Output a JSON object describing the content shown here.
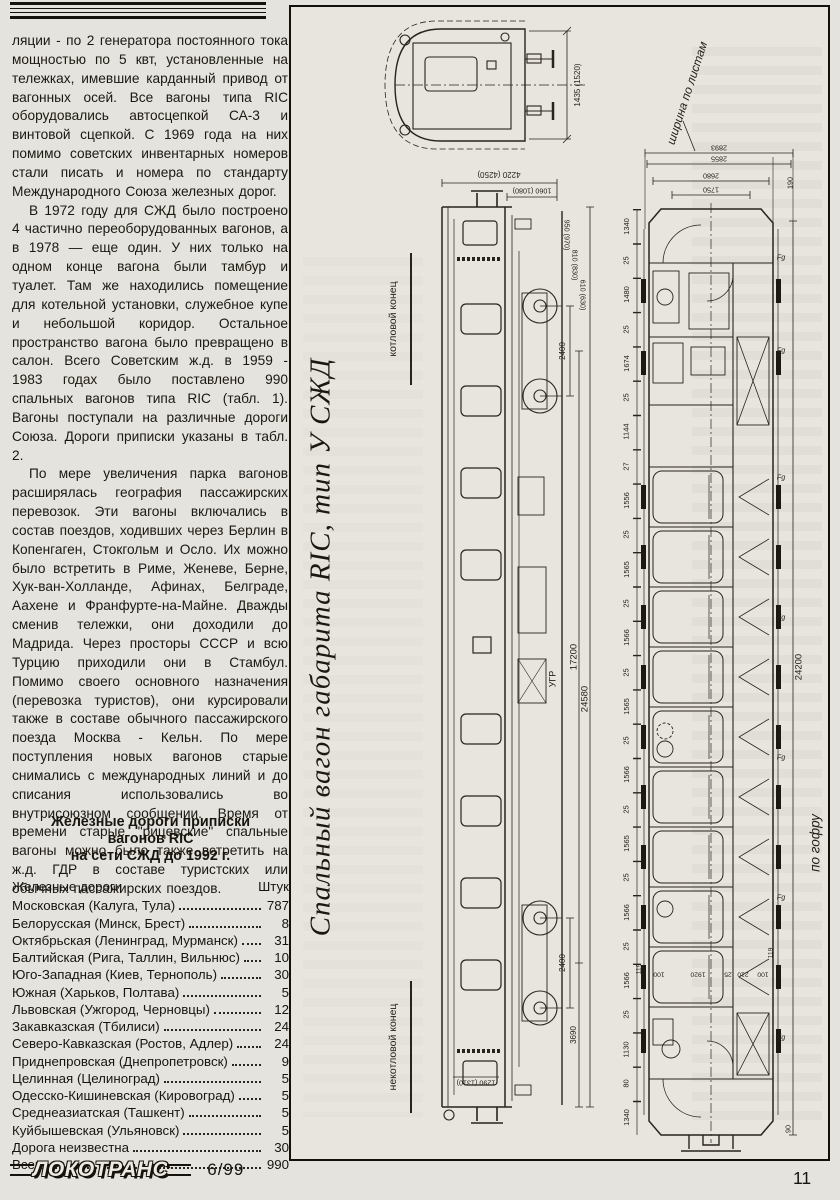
{
  "page": {
    "number": "11",
    "issue": "6/99",
    "logo": "ЛОКОТРАНС"
  },
  "article": {
    "paragraphs": [
      "ляции - по 2 генератора постоянного тока мощностью по 5 квт, установленные на тележках, имевшие карданный привод от вагонных осей. Все вагоны типа RIC оборудовались автосцепкой СА-3 и винтовой сцепкой. С 1969 года на них помимо советских инвентарных номеров стали писать и номера по стандарту Международного Союза железных дорог.",
      "В 1972 году для СЖД было построено 4 частично переоборудованных вагонов, а в 1978 — еще один. У них только на одном конце вагона были тамбур и туалет. Там же находились помещение для котельной установки, служебное купе и небольшой коридор. Остальное пространство вагона было превращено в салон. Всего Советским ж.д. в 1959 - 1983 годах было поставлено 990 спальных вагонов типа RIC (табл. 1). Вагоны поступали на различные дороги Союза. Дороги приписки указаны в табл. 2.",
      "По мере увеличения парка вагонов расширялась география пассажирских перевозок. Эти вагоны включались в состав поездов, ходивших через Берлин в Копенгаген, Стокгольм и Осло. Их можно было встретить в Риме, Женеве, Берне, Хук-ван-Холланде, Афинах, Белграде, Аахене и Франфурте-на-Майне. Дважды сменив тележки, они доходили до Мадрида. Через просторы СССР и всю Турцию приходили они в Стамбул. Помимо своего основного назначения (перевозка туристов), они курсировали также в составе обычного пассажирского поезда Москва - Кельн. По мере поступления новых вагонов старые снимались с международных линий и до списания использовались во внутрисоюзном сообщении. Время от времени старые \"рицевские\" спальные вагоны можно было также встретить на ж.д. ГДР в составе туристских или обычных пассажирских поездов."
    ]
  },
  "table": {
    "title_lines": [
      "Железные дороги приписки",
      "вагонов RIC",
      "на сети СЖД до 1992 г."
    ],
    "header": {
      "name": "Железные дороги",
      "count": "Штук"
    },
    "rows": [
      {
        "name": "Московская (Калуга, Тула)",
        "count": "787"
      },
      {
        "name": "Белорусская (Минск, Брест)",
        "count": "8"
      },
      {
        "name": "Октябрьская (Ленинград, Мурманск)",
        "count": "31"
      },
      {
        "name": "Балтийская (Рига, Таллин, Вильнюс)",
        "count": "10"
      },
      {
        "name": "Юго-Западная (Киев, Тернополь)",
        "count": "30"
      },
      {
        "name": "Южная (Харьков, Полтава)",
        "count": "5"
      },
      {
        "name": "Львовская (Ужгород, Черновцы)",
        "count": "12"
      },
      {
        "name": "Закавказская (Тбилиси)",
        "count": "24"
      },
      {
        "name": "Северо-Кавказская (Ростов, Адлер)",
        "count": "24"
      },
      {
        "name": "Приднепровская (Днепропетровск)",
        "count": "9"
      },
      {
        "name": "Целинная (Целиноград)",
        "count": "5"
      },
      {
        "name": "Одесско-Кишиневская (Кировоград)",
        "count": "5"
      },
      {
        "name": "Среднеазиатская (Ташкент)",
        "count": "5"
      },
      {
        "name": "Куйбышевская (Ульяновск)",
        "count": "5"
      },
      {
        "name": "Дорога неизвестна",
        "count": "30"
      },
      {
        "name": "Всего",
        "count": "990"
      }
    ]
  },
  "drawing": {
    "caption": "Спальный вагон габарита RIC, тип У СЖД",
    "labels": {
      "boiler_end": "котловой конец",
      "non_boiler_end": "некотловой конец",
      "rail_level": "УГР",
      "width_over_sheets": "ширина по листам",
      "width_over_corrugation": "по гофру"
    },
    "dims": {
      "end_height": "1435 (1520)",
      "roof_width": "4220 (4250)",
      "roof_width2": "1060 (1080)",
      "h1": "950 (970)",
      "h2": "810 (830)",
      "h3": "610 (630)",
      "bogie_wheelbase": "2400",
      "buffer_height": "1290 (1310)",
      "end_overhang": "3690",
      "bogie_centers": "17200",
      "body_length": "24580",
      "length_over_corrugation": "24200",
      "d190": "190",
      "d119": "119",
      "d90": "90"
    },
    "plan_top_dims": [
      "2893",
      "2855",
      "2680",
      "1750"
    ],
    "plan_left_chain": [
      "1340",
      "25",
      "1480",
      "25",
      "1674",
      "25",
      "1144",
      "27",
      "1556",
      "25",
      "1565",
      "25",
      "1566",
      "25",
      "1565",
      "25",
      "1566",
      "25",
      "1565",
      "25",
      "1566",
      "25",
      "1566",
      "25",
      "1130",
      "80",
      "1340"
    ],
    "plan_cross_dims": [
      "100",
      "1920",
      "25",
      "210",
      "100"
    ],
    "window_labels": [
      "Fg",
      "Fg",
      "Fg",
      "Fg",
      "Fg",
      "Fg",
      "Fg"
    ]
  }
}
